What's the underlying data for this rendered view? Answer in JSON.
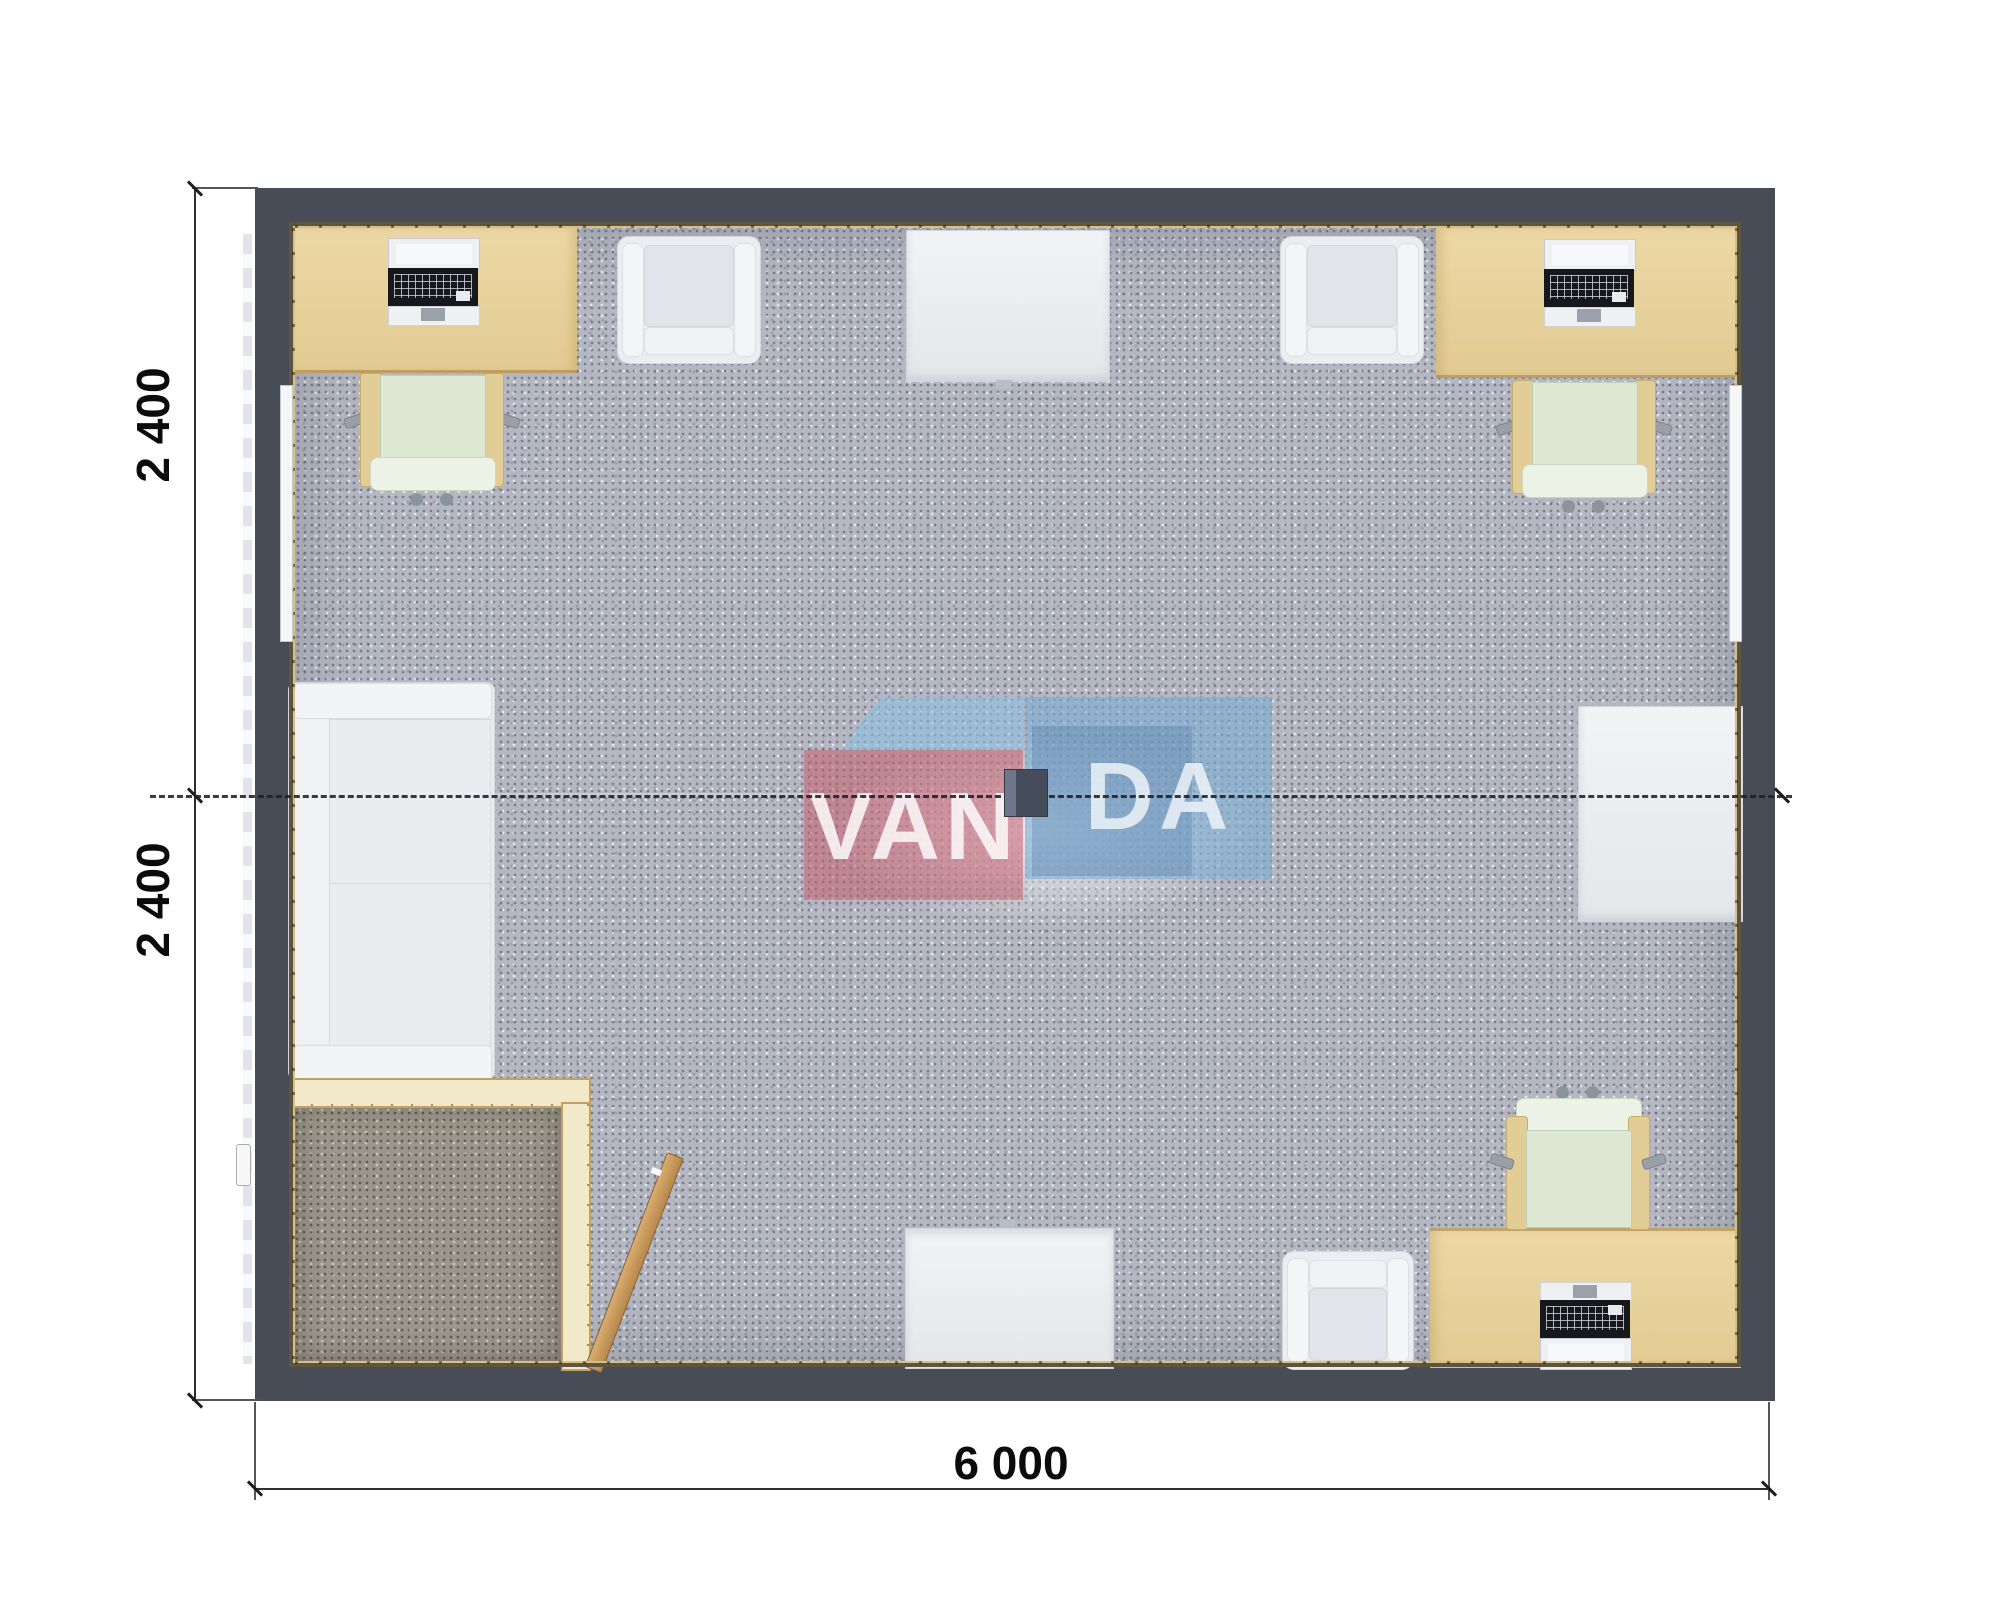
{
  "plan": {
    "type": "modular office floor plan, top view",
    "dimensions": {
      "left_top": "2 400",
      "left_bottom": "2 400",
      "bottom": "6 000"
    },
    "watermark": {
      "brand": "VANDA",
      "text_left": "VAN",
      "text_right": "DA"
    },
    "furniture": [
      "desk-top-left",
      "office-chair-top-left",
      "laptop-top-left",
      "armchair-top-left",
      "meeting-table-top",
      "armchair-top-right",
      "desk-top-right",
      "laptop-top-right",
      "office-chair-top-right",
      "sofa-left",
      "side-table-right",
      "entry-vestibule-partition",
      "entry-door",
      "meeting-table-bottom",
      "armchair-bottom",
      "desk-bottom-right",
      "laptop-bottom-right",
      "office-chair-bottom-right"
    ],
    "colors": {
      "wall": "#484c56",
      "wall_inner_line": "#1c1f24",
      "wall_lining": "#d7c086",
      "carpet": "#b5b8c2",
      "entry_carpet": "#9a968b",
      "desk": "#e6d09c",
      "chair_seat": "#dde8d3",
      "white_furniture": "#ebedf0",
      "partition": "#f1e9c7",
      "door_wood": "#c89a5f",
      "watermark_pink": "#c65c6e",
      "watermark_blue": "#7dacd4",
      "dimension_text": "#0b0b0b"
    }
  }
}
